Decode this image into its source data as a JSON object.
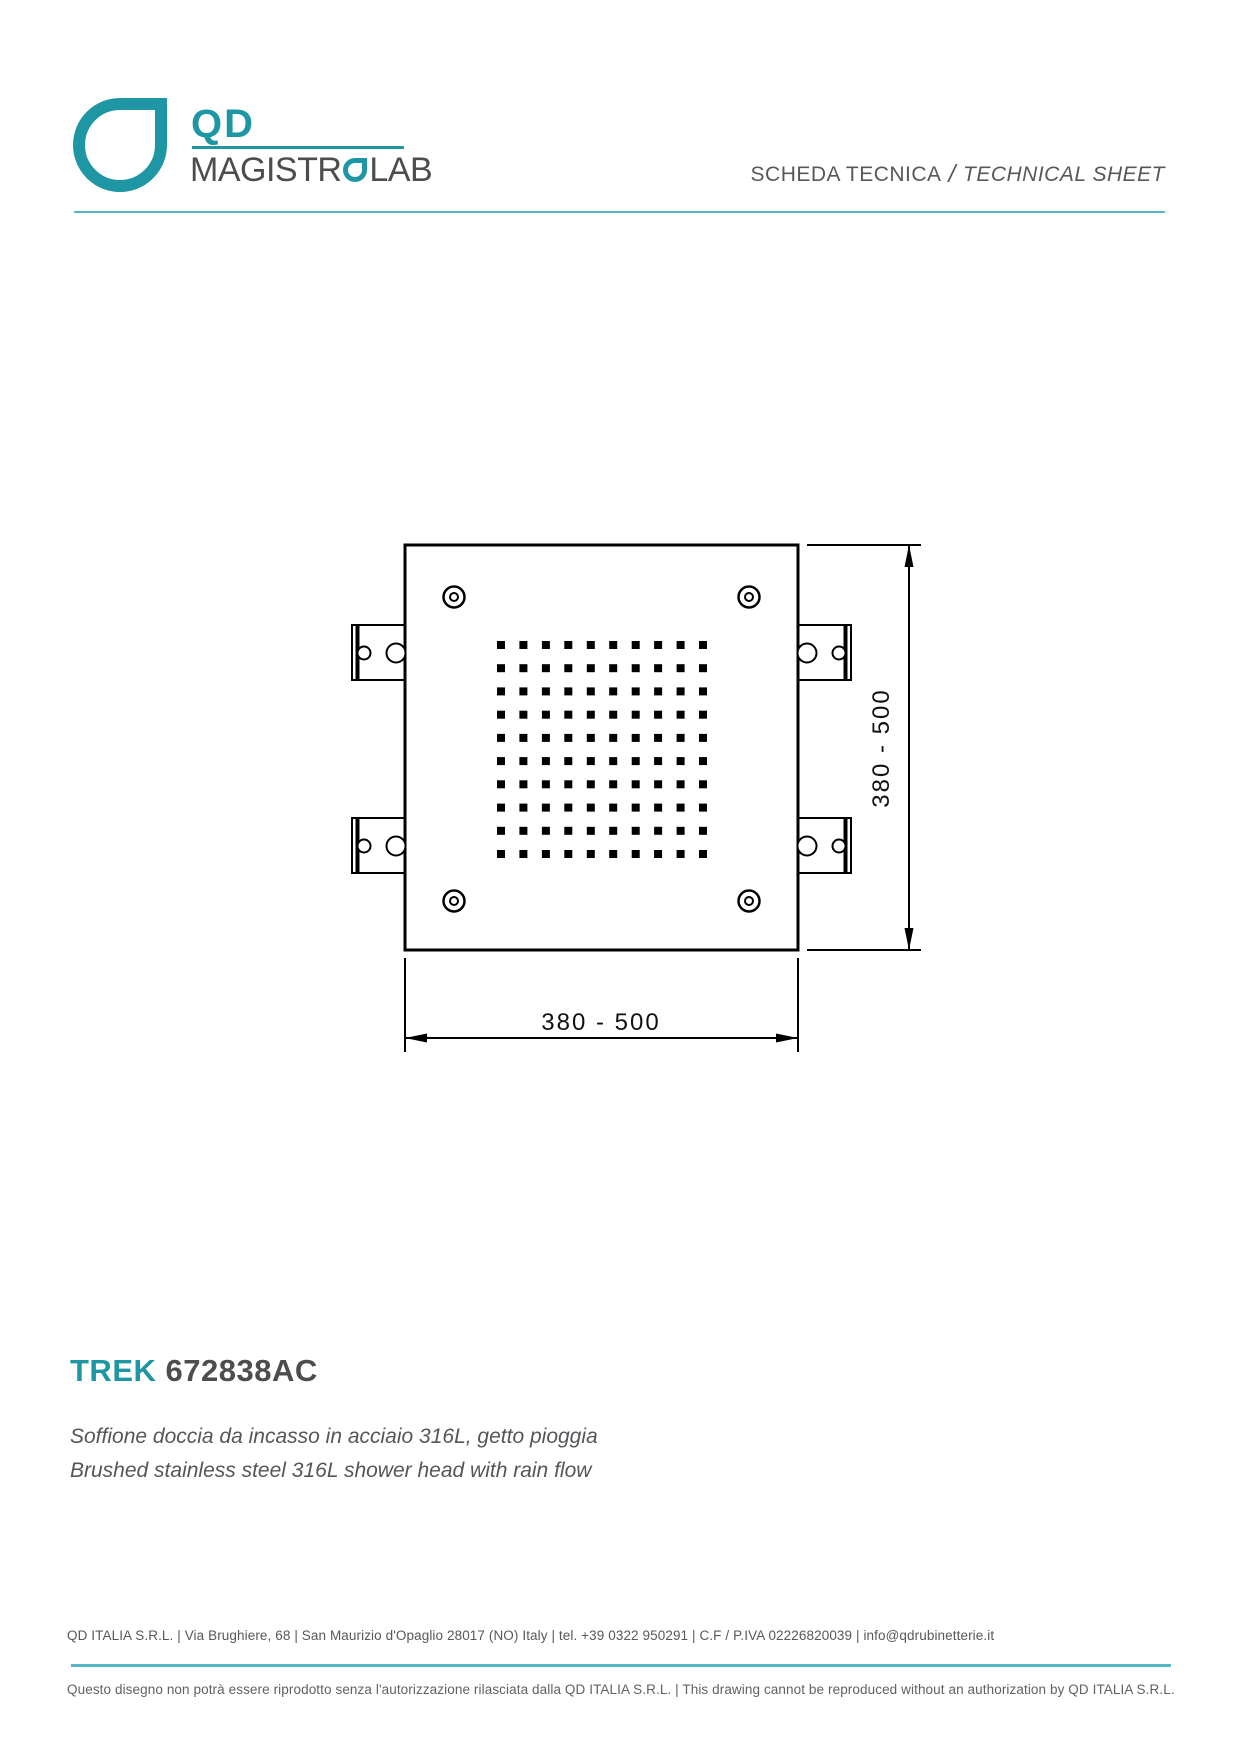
{
  "header": {
    "logo": {
      "qd": "QD",
      "brand_prefix": "MAGISTR",
      "brand_suffix": "LAB",
      "brand_full": "MAGISTROLAB"
    },
    "sheet_label_it": "SCHEDA TECNICA",
    "sheet_label_divider": "/",
    "sheet_label_en": "TECHNICAL SHEET"
  },
  "drawing": {
    "width_label": "380 - 500",
    "height_label": "380 - 500",
    "nozzle_grid": {
      "rows": 10,
      "cols": 10
    },
    "corner_screws": 4,
    "mounting_brackets": 4
  },
  "product": {
    "series": "TREK",
    "code": "672838AC",
    "description_it": "Soffione doccia da incasso in acciaio 316L, getto pioggia",
    "description_en": "Brushed stainless steel 316L shower head with rain flow"
  },
  "footer": {
    "company_line": "QD ITALIA S.R.L. | Via Brughiere, 68 | San Maurizio d'Opaglio 28017 (NO) Italy | tel. +39 0322 950291 | C.F / P.IVA 02226820039 | info@qdrubinetterie.it",
    "disclaimer": "Questo disegno non potrà essere riprodotto senza l'autorizzazione rilasciata dalla QD ITALIA S.R.L. | This drawing cannot be reproduced without an authorization by QD ITALIA S.R.L."
  },
  "colors": {
    "teal": "#1F96A4",
    "divider_teal": "#58B7C6",
    "text_dark": "#4D4D4F",
    "text_gray": "#57585A",
    "line": "#000000"
  }
}
